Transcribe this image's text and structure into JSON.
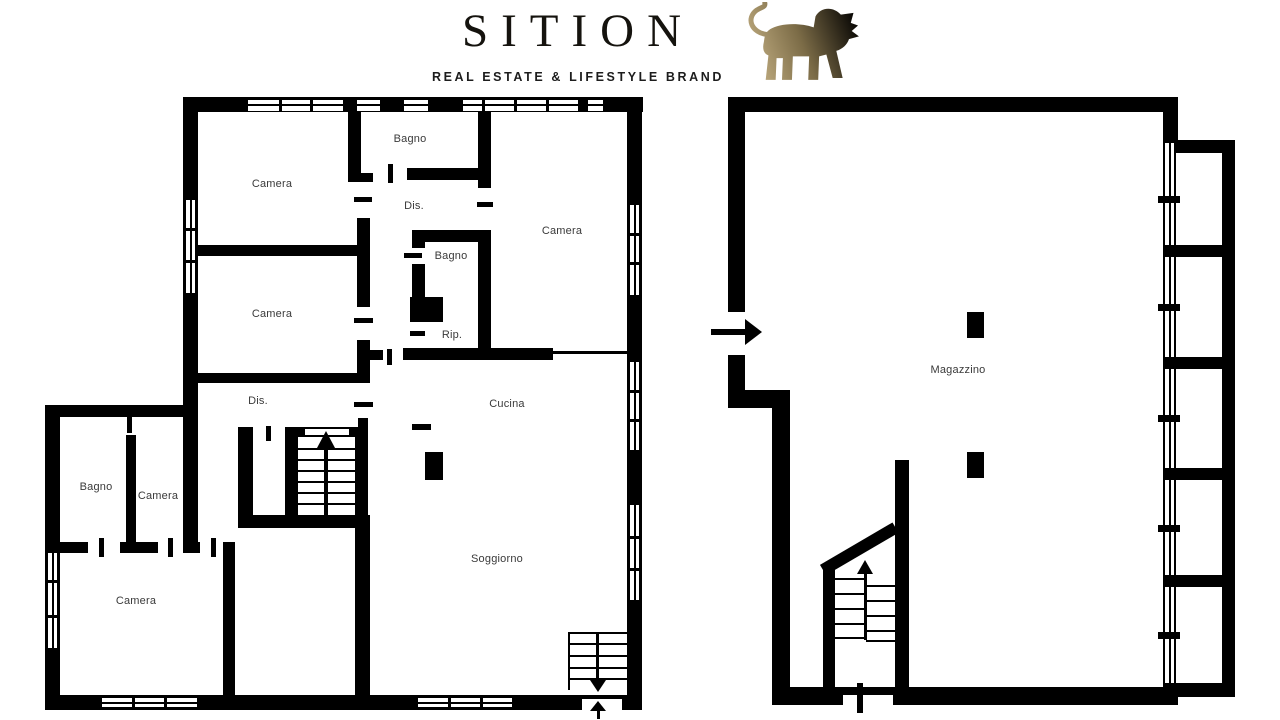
{
  "header": {
    "brand": "SITION",
    "tagline": "REAL ESTATE & LIFESTYLE BRAND",
    "logo_icon": "lion"
  },
  "rooms": {
    "camera_tl": "Camera",
    "bagno_top": "Bagno",
    "dis1": "Dis.",
    "camera_tr": "Camera",
    "bagno_mid": "Bagno",
    "camera_left": "Camera",
    "rip": "Rip.",
    "dis2": "Dis.",
    "cucina": "Cucina",
    "soggiorno": "Soggiorno",
    "bagno_annex": "Bagno",
    "camera_annex_small": "Camera",
    "camera_annex_large": "Camera",
    "magazzino": "Magazzino"
  },
  "colors": {
    "walls": "#000000",
    "room_label": "#3a3a3a",
    "logo_text": "#15130e",
    "logo_gold": "#c4b084",
    "logo_dark": "#0d0b07"
  }
}
